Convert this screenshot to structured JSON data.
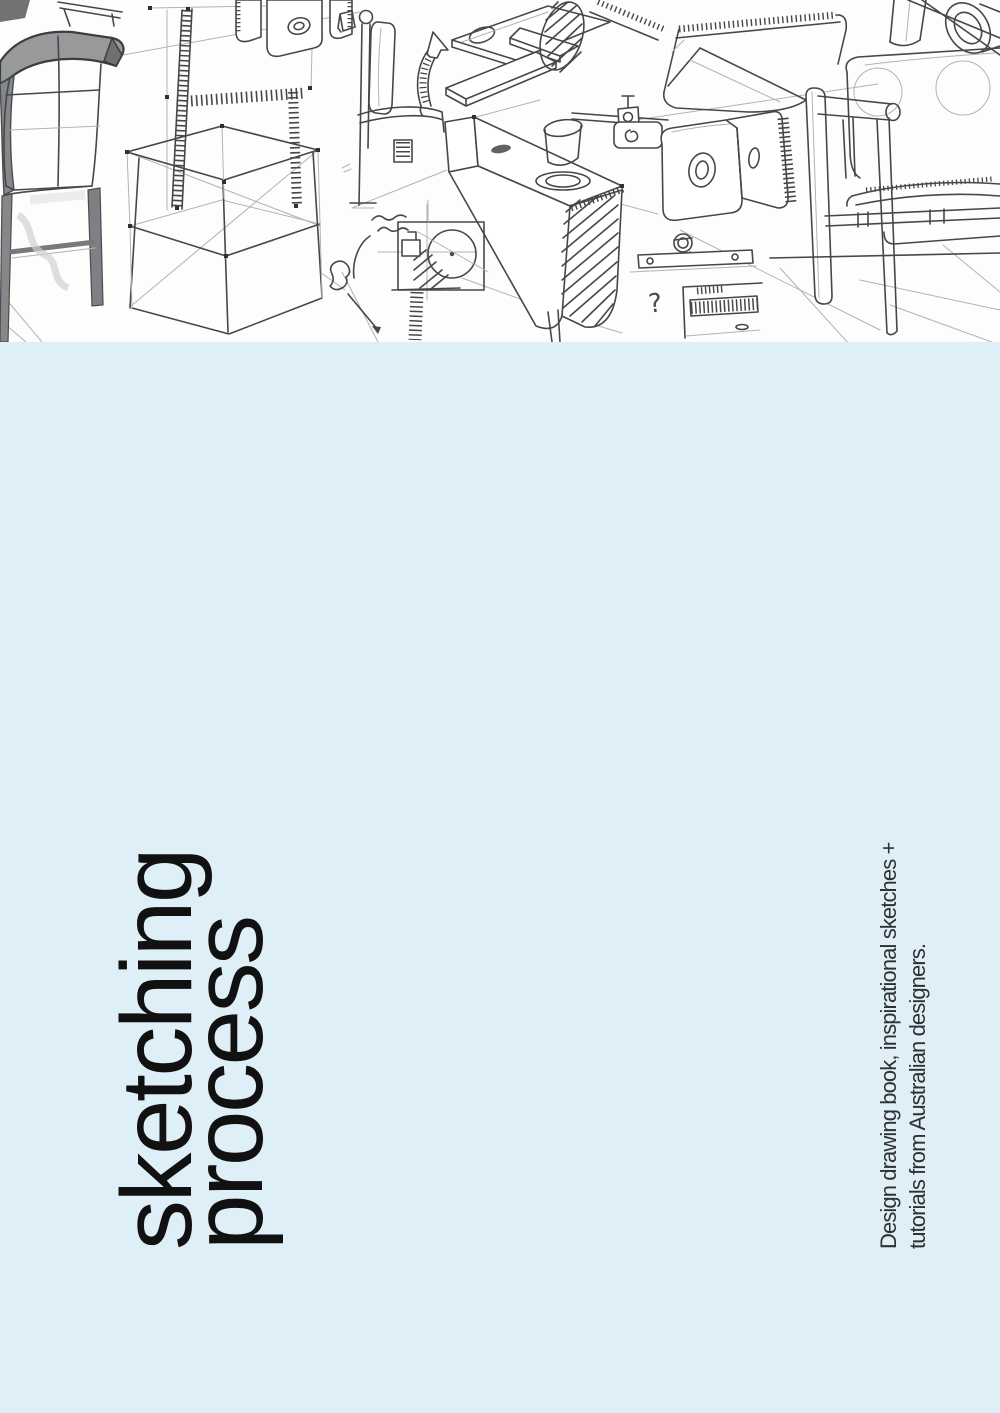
{
  "cover": {
    "title_line1": "sketching",
    "title_line2": "process",
    "subtitle_line1": "Design drawing book, inspirational sketches +",
    "subtitle_line2": "tutorials from Australian designers.",
    "sketch_annotation_glyph": "?",
    "colors": {
      "background_blue": "#deeff8",
      "paper_white": "#fdfdfc",
      "title_text": "#111111",
      "subtitle_text": "#303030",
      "sketch_stroke_dark": "#45484b",
      "sketch_stroke_faint": "#aeb4b8",
      "sketch_fill_gray": "#8e9193"
    }
  }
}
